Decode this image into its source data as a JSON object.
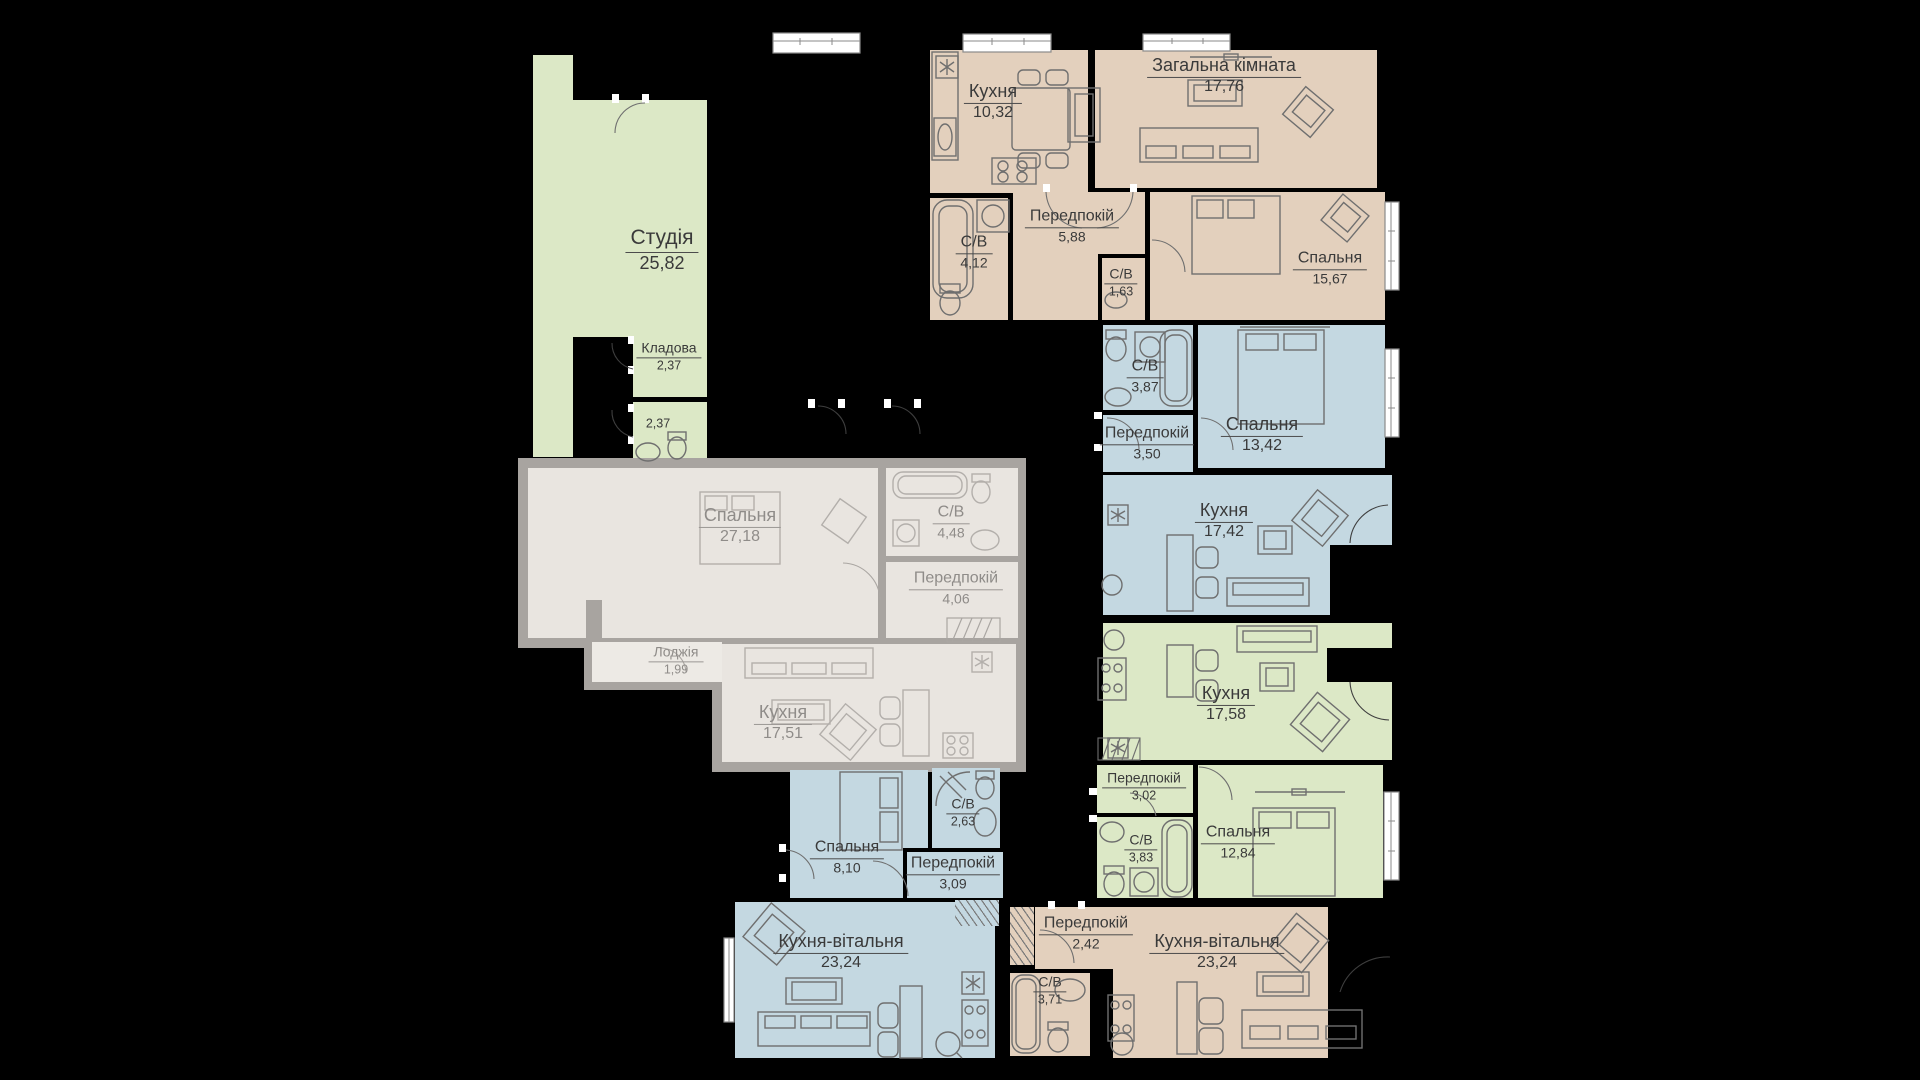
{
  "plan": {
    "type": "residential-floor-plan",
    "language": "uk",
    "colors": {
      "background": "#000000",
      "apartment_beige": "#e3d0bd",
      "apartment_blue": "#c4d8e1",
      "apartment_green": "#dce8c6",
      "sold_unit_fill": "#e9e5e0",
      "sold_unit_walls": "#a8a4a0",
      "label_text": "#3a3a3a",
      "sold_label_text": "#8f8c89",
      "window": "#ffffff"
    }
  },
  "rooms": {
    "studio": {
      "name": "Студія",
      "area": "25,82"
    },
    "kladova": {
      "name": "Кладова",
      "area": "2,37"
    },
    "sv237": {
      "name": "",
      "area": "2,37"
    },
    "kuhnya_a": {
      "name": "Кухня",
      "area": "10,32"
    },
    "zagalna": {
      "name": "Загальна кімната",
      "area": "17,76"
    },
    "sv412": {
      "name": "С/В",
      "area": "4,12"
    },
    "peredpokiy588": {
      "name": "Передпокій",
      "area": "5,88"
    },
    "sv163": {
      "name": "С/В",
      "area": "1,63"
    },
    "spalnya1567": {
      "name": "Спальня",
      "area": "15,67"
    },
    "sv387": {
      "name": "С/В",
      "area": "3,87"
    },
    "peredpokiy350": {
      "name": "Передпокій",
      "area": "3,50"
    },
    "spalnya1342": {
      "name": "Спальня",
      "area": "13,42"
    },
    "kuhnya1742": {
      "name": "Кухня",
      "area": "17,42"
    },
    "kuhnya1758": {
      "name": "Кухня",
      "area": "17,58"
    },
    "peredpokiy302": {
      "name": "Передпокій",
      "area": "3,02"
    },
    "sv383": {
      "name": "С/В",
      "area": "3,83"
    },
    "spalnya1284": {
      "name": "Спальня",
      "area": "12,84"
    },
    "spalnya2718": {
      "name": "Спальня",
      "area": "27,18"
    },
    "sv448": {
      "name": "С/В",
      "area": "4,48"
    },
    "peredpokiy406": {
      "name": "Передпокій",
      "area": "4,06"
    },
    "lodzhiya": {
      "name": "Лоджія",
      "area": "1,99"
    },
    "kuhnya1751": {
      "name": "Кухня",
      "area": "17,51"
    },
    "spalnya810": {
      "name": "Спальня",
      "area": "8,10"
    },
    "sv263": {
      "name": "С/В",
      "area": "2,63"
    },
    "peredpokiy309": {
      "name": "Передпокій",
      "area": "3,09"
    },
    "kv_left": {
      "name": "Кухня-вітальня",
      "area": "23,24"
    },
    "peredpokiy242": {
      "name": "Передпокій",
      "area": "2,42"
    },
    "sv371": {
      "name": "С/В",
      "area": "3,71"
    },
    "kv_right": {
      "name": "Кухня-вітальня",
      "area": "23,24"
    }
  }
}
